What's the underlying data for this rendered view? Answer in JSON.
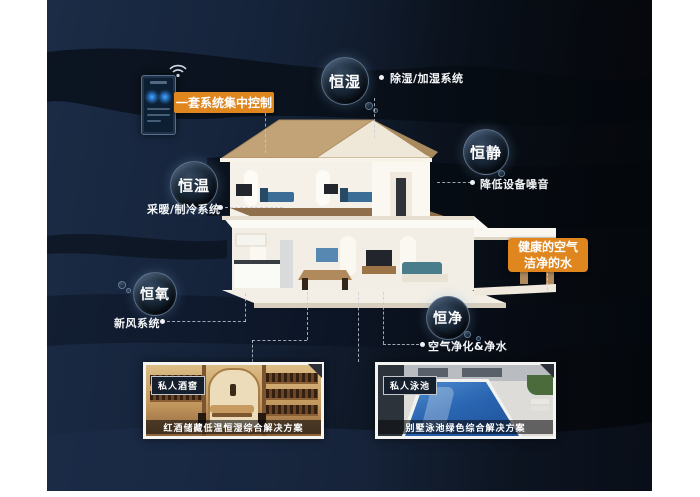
{
  "poster": {
    "theme": "smart-villa-whole-house-system",
    "colors": {
      "accent_orange": "#E0861F",
      "background_navy": "#15233A",
      "background_dark": "#0A0F17",
      "connector_line": "#C3CDD7",
      "bubble_rim": "#9BBEE1"
    }
  },
  "control": {
    "panel_label": "一套系统集中控制",
    "device_icon": "smart-control-panel",
    "wireless_icon": "wifi"
  },
  "features": [
    {
      "name": "恒湿",
      "system": "除湿/加湿系统"
    },
    {
      "name": "恒静",
      "system": "降低设备噪音"
    },
    {
      "name": "恒温",
      "system": "采暖/制冷系统"
    },
    {
      "name": "恒氧",
      "system": "新风系统"
    },
    {
      "name": "恒净",
      "system": "空气净化&净水"
    }
  ],
  "highlight": {
    "line1": "健康的空气",
    "line2": "洁净的水"
  },
  "gallery": [
    {
      "badge": "私人酒窖",
      "caption": "红酒储藏低温恒湿综合解决方案"
    },
    {
      "badge": "私人泳池",
      "caption": "别墅泳池绿色综合解决方案"
    }
  ]
}
